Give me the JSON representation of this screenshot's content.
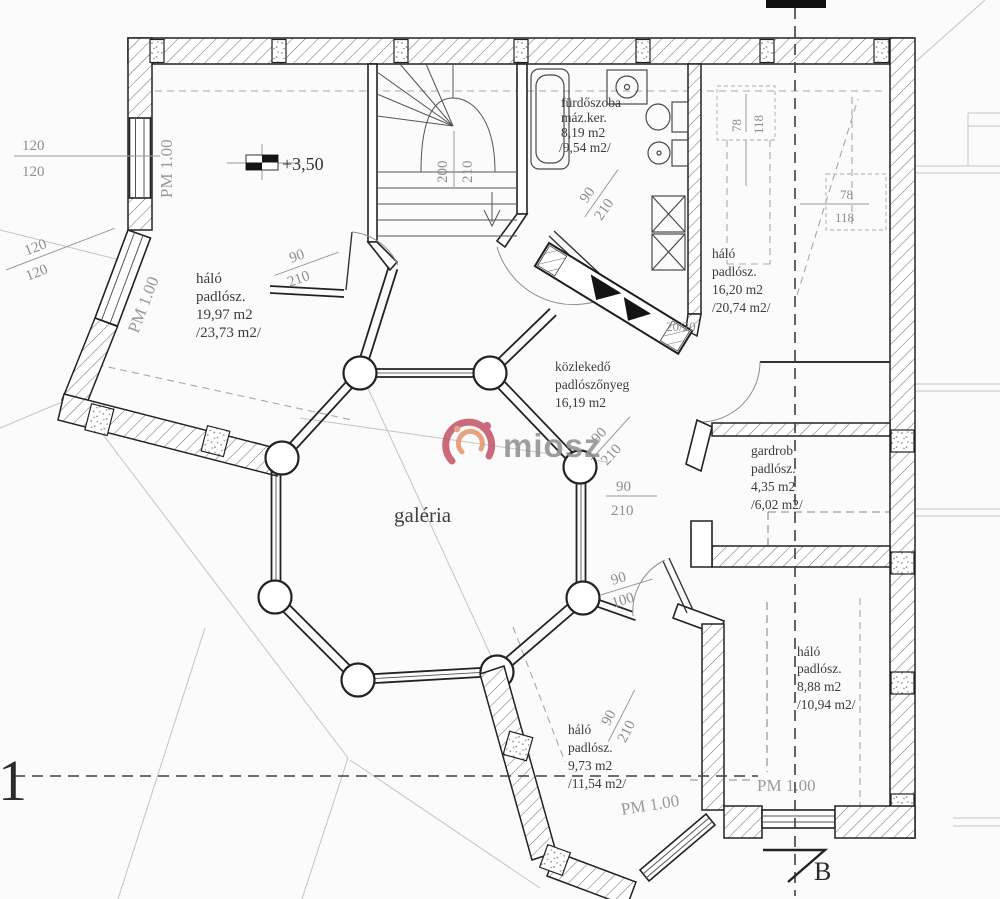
{
  "watermark": {
    "brand": "miosz",
    "accent": "#c65b6d",
    "accent2": "#e59a73",
    "text_color": "#949494"
  },
  "level_marker": {
    "value": "+3,50"
  },
  "section_markers": {
    "left": "1",
    "bottom": "B"
  },
  "rooms": {
    "bedroom_left": {
      "name": "háló",
      "type": "padlósz.",
      "area": "19,97 m2",
      "gross": "/23,73 m2/"
    },
    "bathroom": {
      "name": "fürdőszoba",
      "type": "máz.ker.",
      "area": "8,19 m2",
      "gross": "/9,54 m2/"
    },
    "bedroom_right": {
      "name": "háló",
      "type": "padlósz.",
      "area": "16,20 m2",
      "gross": "/20,74 m2/"
    },
    "hall": {
      "name": "közlekedő",
      "type": "padlószőnyeg",
      "area": "16,19 m2"
    },
    "gallery": {
      "name": "galéria"
    },
    "wardrobe": {
      "name": "gardrob",
      "type": "padlósz.",
      "area": "4,35 m2",
      "gross": "/6,02 m2/"
    },
    "bedroom_se": {
      "name": "háló",
      "type": "padlósz.",
      "area": "8,88 m2",
      "gross": "/10,94 m2/"
    },
    "bedroom_s": {
      "name": "háló",
      "type": "padlósz.",
      "area": "9,73 m2",
      "gross": "/11,54 m2/"
    }
  },
  "dims": {
    "window_left_1": {
      "num": "120",
      "den": "120"
    },
    "window_left_2": {
      "num": "120",
      "den": "120"
    },
    "pm_window_1": "PM 1.00",
    "pm_window_2": "PM 1.00",
    "door_bedroom_left": {
      "num": "90",
      "den": "210"
    },
    "stair": {
      "num": "200",
      "den": "210"
    },
    "door_bathroom": {
      "num": "90",
      "den": "210"
    },
    "dormer_top": {
      "num": "78",
      "den": "118"
    },
    "dormer_right": {
      "num": "78",
      "den": "118"
    },
    "chimney": "20/20",
    "door_hall": {
      "num": "90",
      "den": "210"
    },
    "opening_hall": {
      "num": "90",
      "den": "210"
    },
    "opening_gallery": {
      "num": "90",
      "den": "100"
    },
    "door_bedroom_s": {
      "num": "90",
      "den": "210"
    },
    "pm_bedroom_s": "PM 1.00",
    "pm_bedroom_se": "PM 1.00"
  }
}
